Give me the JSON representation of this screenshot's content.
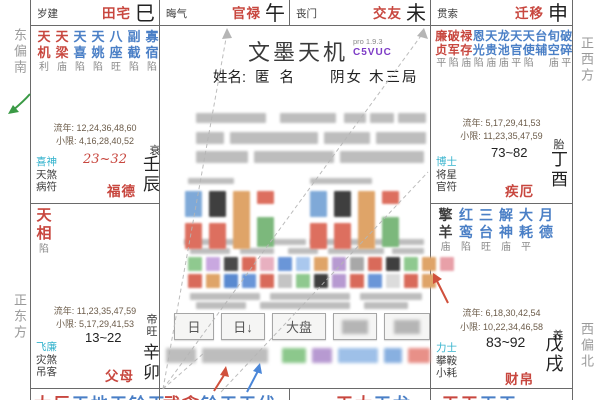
{
  "app": {
    "title": "文墨天机",
    "version": "pro 1.9.3",
    "code": "C5VUC"
  },
  "profile": {
    "name_label": "姓名:",
    "name": "匿 名",
    "gender": "阴女",
    "bureau": "木三局"
  },
  "compass": {
    "east_south": "东偏南",
    "east": "正东方",
    "west": "正西方",
    "west_north": "西偏北"
  },
  "top_row": [
    {
      "god": "岁建",
      "palace": "田宅",
      "branch": "巳"
    },
    {
      "god": "晦气",
      "palace": "官禄",
      "branch": "午"
    },
    {
      "god": "丧门",
      "palace": "交友",
      "branch": "未"
    },
    {
      "god": "贯索",
      "palace": "迁移",
      "branch": "申"
    }
  ],
  "palaces": {
    "chen": {
      "stars": [
        [
          "天机",
          "red"
        ],
        [
          "天梁",
          "red"
        ],
        [
          "天喜",
          "blue"
        ],
        [
          "天姚",
          "blue"
        ],
        [
          "八座",
          "blue"
        ],
        [
          "副截",
          "blue"
        ],
        [
          "寡宿",
          "blue"
        ]
      ],
      "status": [
        "利",
        "庙",
        "陷",
        "陷",
        "旺",
        "陷",
        "陷"
      ],
      "liunian": "流年: 12,24,36,48,60",
      "xiaoxian": "小限: 4,16,28,40,52",
      "stage": "衰",
      "range": "23~32",
      "gods": [
        "喜神",
        "天煞",
        "病符"
      ],
      "palace_name": "福德",
      "ganzhi": "壬辰"
    },
    "mao": {
      "stars": [
        [
          "天相",
          "red"
        ]
      ],
      "status": [
        "陷"
      ],
      "liunian": "流年: 11,23,35,47,59",
      "xiaoxian": "小限: 5,17,29,41,53",
      "stage": "帝旺",
      "range": "13~22",
      "gods": [
        "飞廉",
        "灾煞",
        "吊客"
      ],
      "palace_name": "父母",
      "ganzhi": "辛卯"
    },
    "you": {
      "stars": [
        [
          "廉贞",
          "red"
        ],
        [
          "破军",
          "red"
        ],
        [
          "禄存",
          "red"
        ],
        [
          "恩光",
          "blue"
        ],
        [
          "天贵",
          "blue"
        ],
        [
          "龙池",
          "blue"
        ],
        [
          "天官",
          "blue"
        ],
        [
          "天使",
          "blue"
        ],
        [
          "台辅",
          "blue"
        ],
        [
          "旬空",
          "blue"
        ],
        [
          "破碎",
          "blue"
        ]
      ],
      "status": [
        "平",
        "陷",
        "庙",
        "陷",
        "庙",
        "庙",
        "平",
        "陷",
        "",
        "庙",
        "平"
      ],
      "liunian": "流年: 5,17,29,41,53",
      "xiaoxian": "小限: 11,23,35,47,59",
      "stage": "胎",
      "range": "73~82",
      "gods": [
        "博士",
        "将星",
        "官符"
      ],
      "palace_name": "疾厄",
      "ganzhi": "丁酉"
    },
    "xu": {
      "stars": [
        [
          "擎羊",
          "dark"
        ],
        [
          "红鸾",
          "blue"
        ],
        [
          "三台",
          "blue"
        ],
        [
          "解神",
          "blue"
        ],
        [
          "大耗",
          "blue"
        ],
        [
          "月德",
          "blue"
        ]
      ],
      "status": [
        "庙",
        "陷",
        "旺",
        "庙",
        "平",
        ""
      ],
      "liunian": "流年: 6,18,30,42,54",
      "xiaoxian": "小限: 10,22,34,46,58",
      "stage": "养",
      "range": "83~92",
      "gods": [
        "力士",
        "攀鞍",
        "小耗"
      ],
      "palace_name": "财帛",
      "ganzhi": "戊戌"
    }
  },
  "bottom_row": [
    {
      "chars": [
        [
          "太",
          "red"
        ],
        [
          "巨",
          "red"
        ],
        [
          "天",
          "blue"
        ],
        [
          "地",
          "blue"
        ],
        [
          "天",
          "blue"
        ],
        [
          "铃",
          "blue"
        ],
        [
          "天",
          "blue"
        ]
      ]
    },
    {
      "chars": [
        [
          "武",
          "red"
        ],
        [
          "贪",
          "red"
        ],
        [
          "铃",
          "blue"
        ],
        [
          "天",
          "blue"
        ],
        [
          "天",
          "blue"
        ],
        [
          "伏",
          "blue"
        ]
      ]
    },
    {
      "chars": [
        [
          "天",
          "red"
        ],
        [
          "太",
          "red"
        ],
        [
          "天",
          "blue"
        ],
        [
          "龙",
          "blue"
        ]
      ]
    },
    {
      "chars": [
        [
          "天",
          "red"
        ],
        [
          "天",
          "red"
        ],
        [
          "天",
          "blue"
        ],
        [
          "天",
          "blue"
        ]
      ]
    }
  ],
  "toolbar": {
    "buttons": [
      {
        "label": "日",
        "blurred": false
      },
      {
        "label": "日↓",
        "blurred": false
      },
      {
        "label": "大盘",
        "blurred": false
      },
      {
        "label": "",
        "blurred": true
      },
      {
        "label": "",
        "blurred": true
      }
    ]
  },
  "center_blocks": {
    "fortune_columns": [
      [
        "#7fa9d8",
        "#dd6f5f"
      ],
      [
        "#3f3f3f",
        "#dd6f5f"
      ],
      [
        "#dfa468"
      ],
      [
        "#dd6f5f",
        "#7cb87c"
      ]
    ],
    "strip_row1": [
      "#8fc98f",
      "#c9a8e0",
      "#4a4a4a",
      "#d96a5a",
      "#e8b0c0",
      "#6a96d8",
      "#aac8ee",
      "#dfa468",
      "#b79ad1",
      "#a8a8a8",
      "#d96a5a",
      "#3f3f3f",
      "#8fc98f",
      "#dfa468",
      "#e8a0a8"
    ],
    "strip_row2": [
      "#d96a5a",
      "#dfa468",
      "#5a8ad0",
      "#6a96d8",
      "#d96a5a",
      "#c4c4c4",
      "#8fc98f",
      "#3f3f3f",
      "#b79ad1",
      "#d96a5a",
      "#6a96d8",
      "#dcdcdc",
      "#d96a5a",
      "#dfa468"
    ],
    "tags": [
      "#bdbdbd",
      "#bdbdbd",
      "#8cc88c",
      "#b79ad1",
      "#9ec0e8",
      "#88b0e0",
      "#e89088"
    ]
  },
  "colors": {
    "major_star": "#c8473f",
    "minor_star": "#4a7fc6",
    "malefic_star": "#3d3d3d",
    "god_accent": "#35b3cd",
    "palace_name": "#c8473f",
    "code": "#7d3bc6",
    "grid": "#6a6a6a",
    "dashed_line": "#b5b5b5",
    "arrow_red": "#d0503c",
    "arrow_blue": "#4a86d8",
    "arrow_green": "#3a9a45"
  }
}
